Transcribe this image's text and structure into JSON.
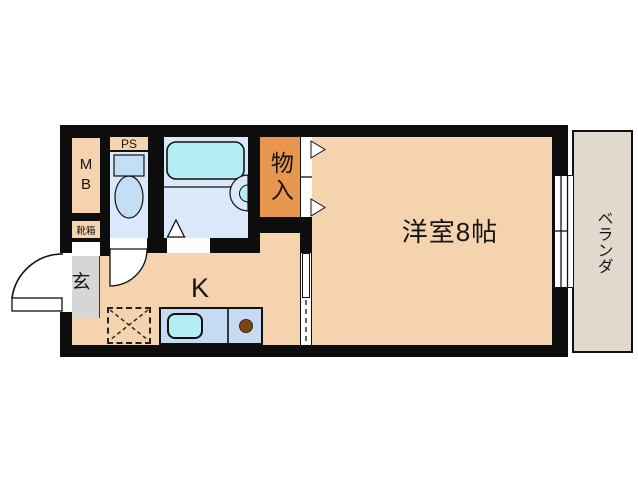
{
  "plan": {
    "rooms": {
      "main_room": {
        "label": "洋室8帖"
      },
      "veranda": {
        "label": "ベランダ"
      },
      "kitchen": {
        "label": "K"
      },
      "closet": {
        "label": "物入"
      },
      "entrance": {
        "label": "玄"
      },
      "meter_box": {
        "label": "MB"
      },
      "shoe_box": {
        "label": "靴箱"
      },
      "pipe_space": {
        "label": "PS"
      }
    },
    "colors": {
      "wall": "#0d0d0d",
      "floor": "#f4d3ae",
      "closet": "#e8954e",
      "wet_floor": "#dbe8fa",
      "fixture_blue": "#c4def5",
      "water_cyan": "#b5edf5",
      "counter_blue": "#c6dbf3",
      "veranda": "#e0d9cd",
      "entrance_floor": "#d6d6d6",
      "burner_brown": "#7c4418"
    }
  }
}
